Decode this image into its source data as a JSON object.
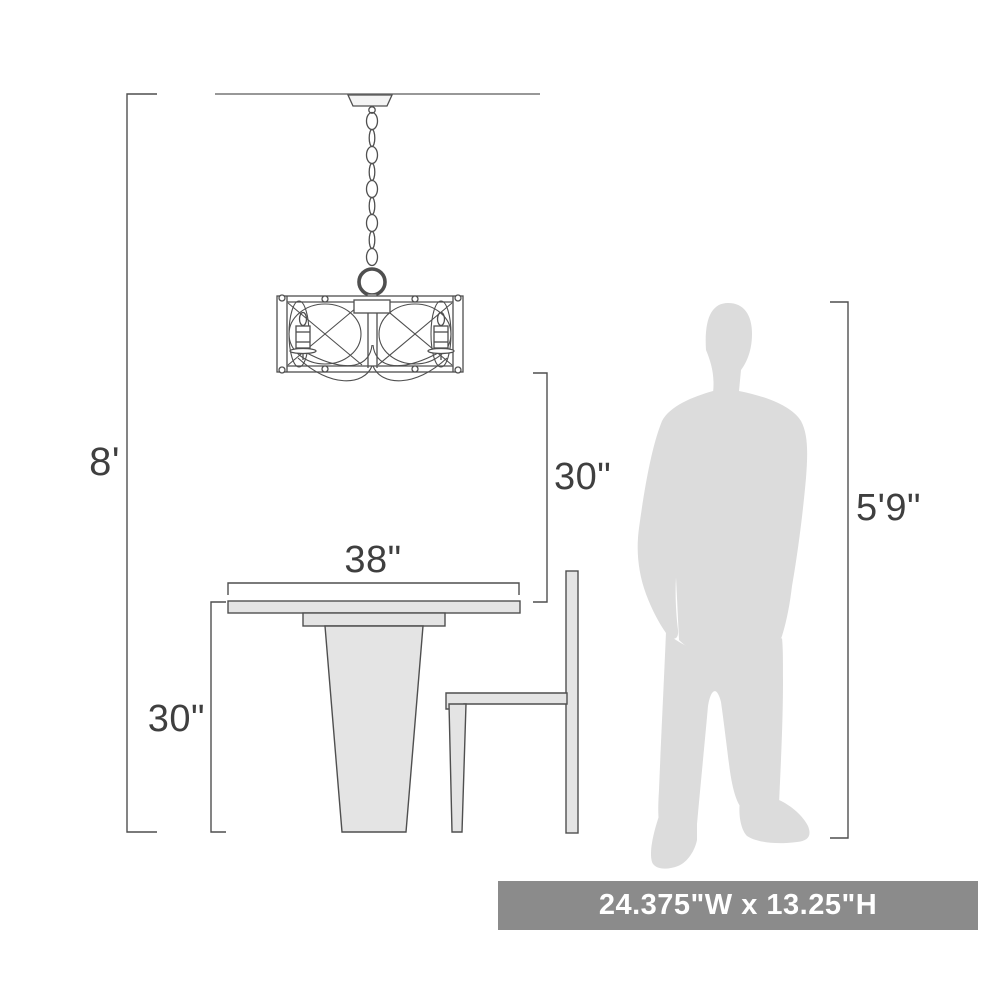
{
  "scene": {
    "dimensions": {
      "ceiling_height": "8'",
      "fixture_to_surface": "30\"",
      "table_width": "38\"",
      "table_height": "30\"",
      "person_height": "5'9\""
    },
    "banner": {
      "text": "24.375\"W x 13.25\"H",
      "background": "#8b8b8b",
      "text_color": "#ffffff"
    },
    "objects": {
      "fixture": "drum-chandelier-with-chain",
      "furniture": [
        "pedestal-dining-table",
        "side-chair"
      ],
      "person": "standing-human-silhouette"
    },
    "colors": {
      "line": "#4f4f4f",
      "ceiling_line": "#777777",
      "furniture_fill": "#e4e4e4",
      "person_fill": "#dcdcdc",
      "background": "#ffffff"
    }
  }
}
